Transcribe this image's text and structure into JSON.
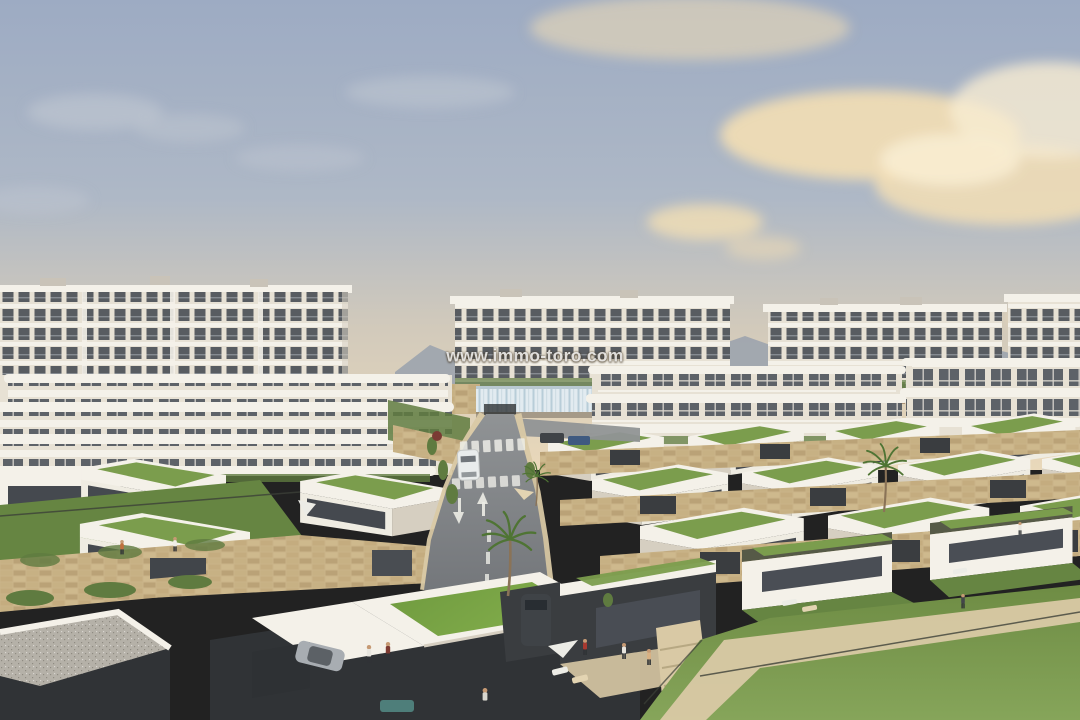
{
  "watermark": {
    "text": "www.immo-toro.com"
  },
  "scene": {
    "description": "Aerial architectural rendering of a hillside residential development at dusk: rows of white apartment blocks in the background, terraces of modern flat-roofed villas with green grass roofs in the mid- and foreground, a central road descending toward the viewer with crosswalks and arrows, sandstone retaining walls, palm trees, parked cars, people in gardens and a large lawn at lower right under a warm cloudy sky.",
    "objects": [
      "sky",
      "clouds",
      "mountain-ridge",
      "apartment-block-far-left",
      "apartment-block-far-center",
      "apartment-block-far-right",
      "apartment-block-far-edge",
      "water-feature",
      "pergola",
      "apartment-terraces-left",
      "apartment-row-right",
      "villa-rows-with-green-roofs",
      "stone-retaining-walls",
      "garage-doors",
      "road",
      "crosswalks",
      "road-arrows",
      "white-car",
      "parked-cars",
      "palm-trees",
      "bushes",
      "foreground-villas",
      "carport-suv",
      "silver-car",
      "patio-umbrellas",
      "sun-loungers",
      "lawn",
      "sand-path",
      "fences",
      "people",
      "watermark"
    ]
  },
  "palette": {
    "sky_top": "#9dabc3",
    "sky_mid": "#aeb8c6",
    "sky_warm": "#d2cabb",
    "sky_horizon": "#e9d8ba",
    "cloud_warm": "#f3deb4",
    "cloud_bright": "#f8ecd2",
    "cloud_grey": "#c6cbd3",
    "mountain": "#99a1ad",
    "bld_white": "#f4f1e9",
    "bld_base": "#e7e1d4",
    "bld_facade": "#efece2",
    "bld_shadow": "#d6cfc1",
    "window_dark": "#585c61",
    "window_glass": "#5d6268",
    "glazing_dark": "#45494f",
    "roof_grass": "#7b9d4d",
    "roof_grass_bright": "#6f9a3f",
    "roof_grass_light": "#82ad4b",
    "hedge": "#5f7b40",
    "garden": "#668542",
    "lawn": "#6e8c44",
    "lawn_light": "#86a55a",
    "palm_frond": "#4f7434",
    "trunk": "#8a7357",
    "stone": "#cab489",
    "stone_dark": "#a98f66",
    "olive_trim": "#565a47",
    "charcoal": "#3a3d40",
    "wall_dark": "#303336",
    "road": "#74777b",
    "road_light": "#909395",
    "marking": "#ecece6",
    "sand": "#d9c9a5",
    "sand_bright": "#e3d4b2",
    "water": "#e2ebf0",
    "water_streak": "#b8cdd8",
    "car_white": "#e9ecec",
    "car_dark": "#3f4347",
    "car_blue": "#3f5a80",
    "car_silver": "#a8adb2",
    "skin": "#c69a74",
    "gravel": "#b5b1a8",
    "teal_sofa": "#4e7e7a",
    "watermark_color": "rgba(255,255,255,0.82)",
    "watermark_shadow": "rgba(70,58,38,0.85)"
  }
}
